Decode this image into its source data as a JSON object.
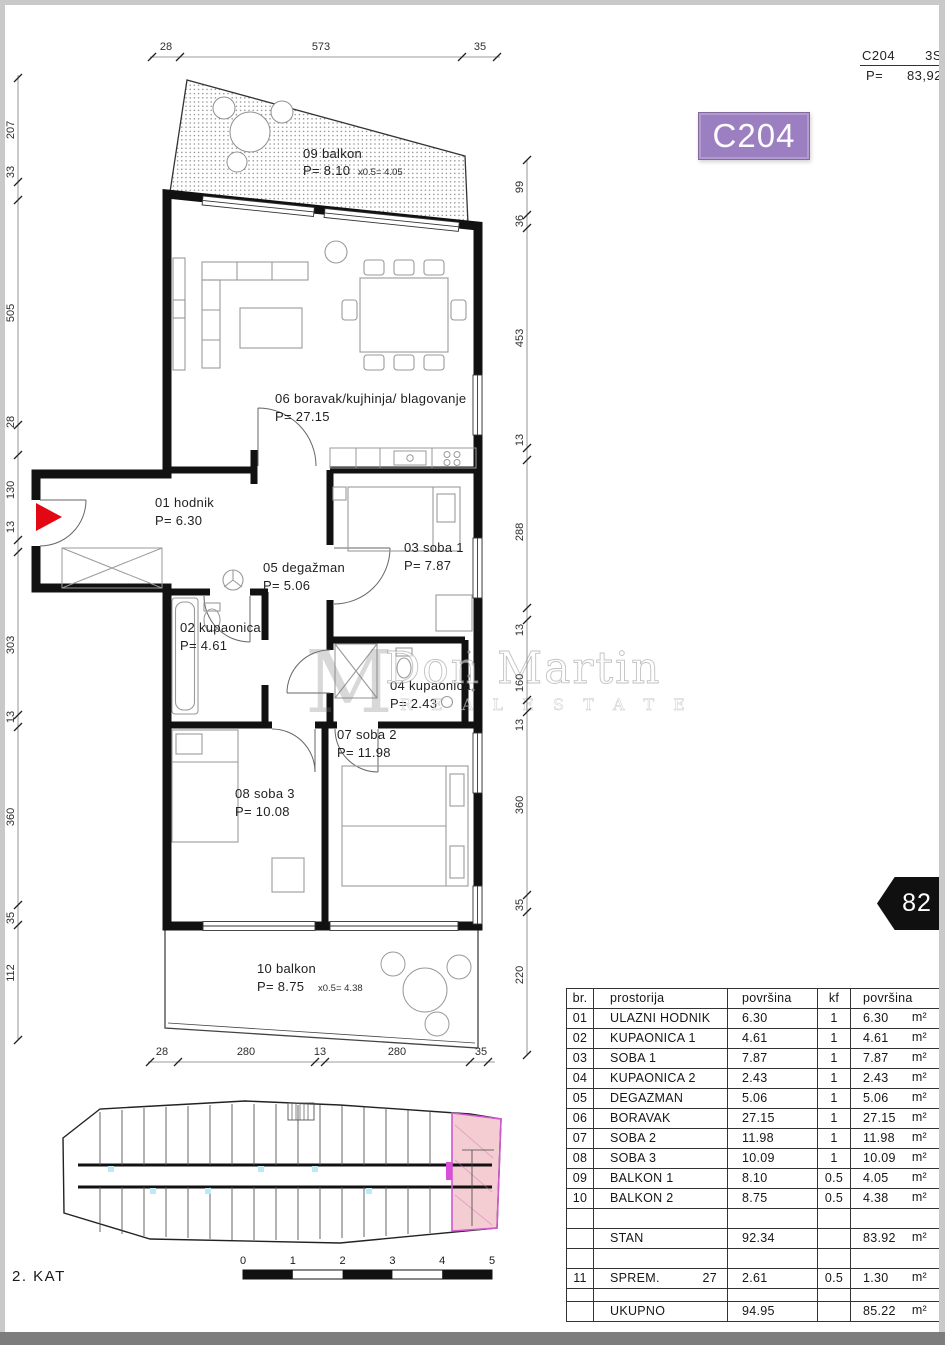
{
  "page": {
    "floor_label": "2. KAT",
    "page_number": "82"
  },
  "header": {
    "code": "C204",
    "type": "3S",
    "p_label": "P=",
    "p_value": "83,92"
  },
  "badge": {
    "label": "C204"
  },
  "watermark": {
    "monogram": "M",
    "line1": "Don Martin",
    "line2": "R E A L  E S T A T E"
  },
  "dims": {
    "top": [
      "28",
      "573",
      "35"
    ],
    "left": [
      "207",
      "33",
      "505",
      "28",
      "130",
      "13",
      "303",
      "13",
      "360",
      "35",
      "112"
    ],
    "right": [
      "99",
      "36",
      "453",
      "13",
      "288",
      "13",
      "160",
      "13",
      "360",
      "35",
      "220"
    ],
    "bottom": [
      "28",
      "280",
      "13",
      "280",
      "35"
    ]
  },
  "rooms": {
    "r09": {
      "name": "09 balkon",
      "area": "P= 8.10",
      "factor": "x0.5=  4.05"
    },
    "r06": {
      "name": "06 boravak/kujhinja/ blagovanje",
      "area": "P= 27.15"
    },
    "r01": {
      "name": "01 hodnik",
      "area": "P= 6.30"
    },
    "r05": {
      "name": "05 degažman",
      "area": "P= 5.06"
    },
    "r03": {
      "name": "03 soba 1",
      "area": "P= 7.87"
    },
    "r02": {
      "name": "02 kupaonica",
      "area": "P= 4.61"
    },
    "r04": {
      "name": "04 kupaonica",
      "area": "P= 2.43"
    },
    "r07": {
      "name": "07 soba 2",
      "area": "P= 11.98"
    },
    "r08": {
      "name": "08 soba 3",
      "area": "P= 10.08"
    },
    "r10": {
      "name": "10 balkon",
      "area": "P= 8.75",
      "factor": "x0.5=  4.38"
    }
  },
  "scale_bar": {
    "ticks": [
      "0",
      "1",
      "2",
      "3",
      "4",
      "5"
    ]
  },
  "table": {
    "headers": [
      "br.",
      "prostorija",
      "površina",
      "kf",
      "površina"
    ],
    "rows": [
      {
        "br": "01",
        "name": "ULAZNI HODNIK",
        "area": "6.30",
        "kf": "1",
        "total": "6.30",
        "unit": "m²"
      },
      {
        "br": "02",
        "name": "KUPAONICA 1",
        "area": "4.61",
        "kf": "1",
        "total": "4.61",
        "unit": "m²"
      },
      {
        "br": "03",
        "name": "SOBA 1",
        "area": "7.87",
        "kf": "1",
        "total": "7.87",
        "unit": "m²"
      },
      {
        "br": "04",
        "name": "KUPAONICA 2",
        "area": "2.43",
        "kf": "1",
        "total": "2.43",
        "unit": "m²"
      },
      {
        "br": "05",
        "name": "DEGAZMAN",
        "area": "5.06",
        "kf": "1",
        "total": "5.06",
        "unit": "m²"
      },
      {
        "br": "06",
        "name": "BORAVAK",
        "area": "27.15",
        "kf": "1",
        "total": "27.15",
        "unit": "m²"
      },
      {
        "br": "07",
        "name": "SOBA 2",
        "area": "11.98",
        "kf": "1",
        "total": "11.98",
        "unit": "m²"
      },
      {
        "br": "08",
        "name": "SOBA 3",
        "area": "10.09",
        "kf": "1",
        "total": "10.09",
        "unit": "m²"
      },
      {
        "br": "09",
        "name": "BALKON 1",
        "area": "8.10",
        "kf": "0.5",
        "total": "4.05",
        "unit": "m²"
      },
      {
        "br": "10",
        "name": "BALKON 2",
        "area": "8.75",
        "kf": "0.5",
        "total": "4.38",
        "unit": "m²"
      }
    ],
    "stan": {
      "name": "STAN",
      "area": "92.34",
      "total": "83.92",
      "unit": "m²"
    },
    "sprem": {
      "br": "11",
      "name": "SPREM.",
      "suffix": "27",
      "area": "2.61",
      "kf": "0.5",
      "total": "1.30",
      "unit": "m²"
    },
    "ukupno": {
      "name": "UKUPNO",
      "area": "94.95",
      "total": "85.22",
      "unit": "m²"
    }
  }
}
